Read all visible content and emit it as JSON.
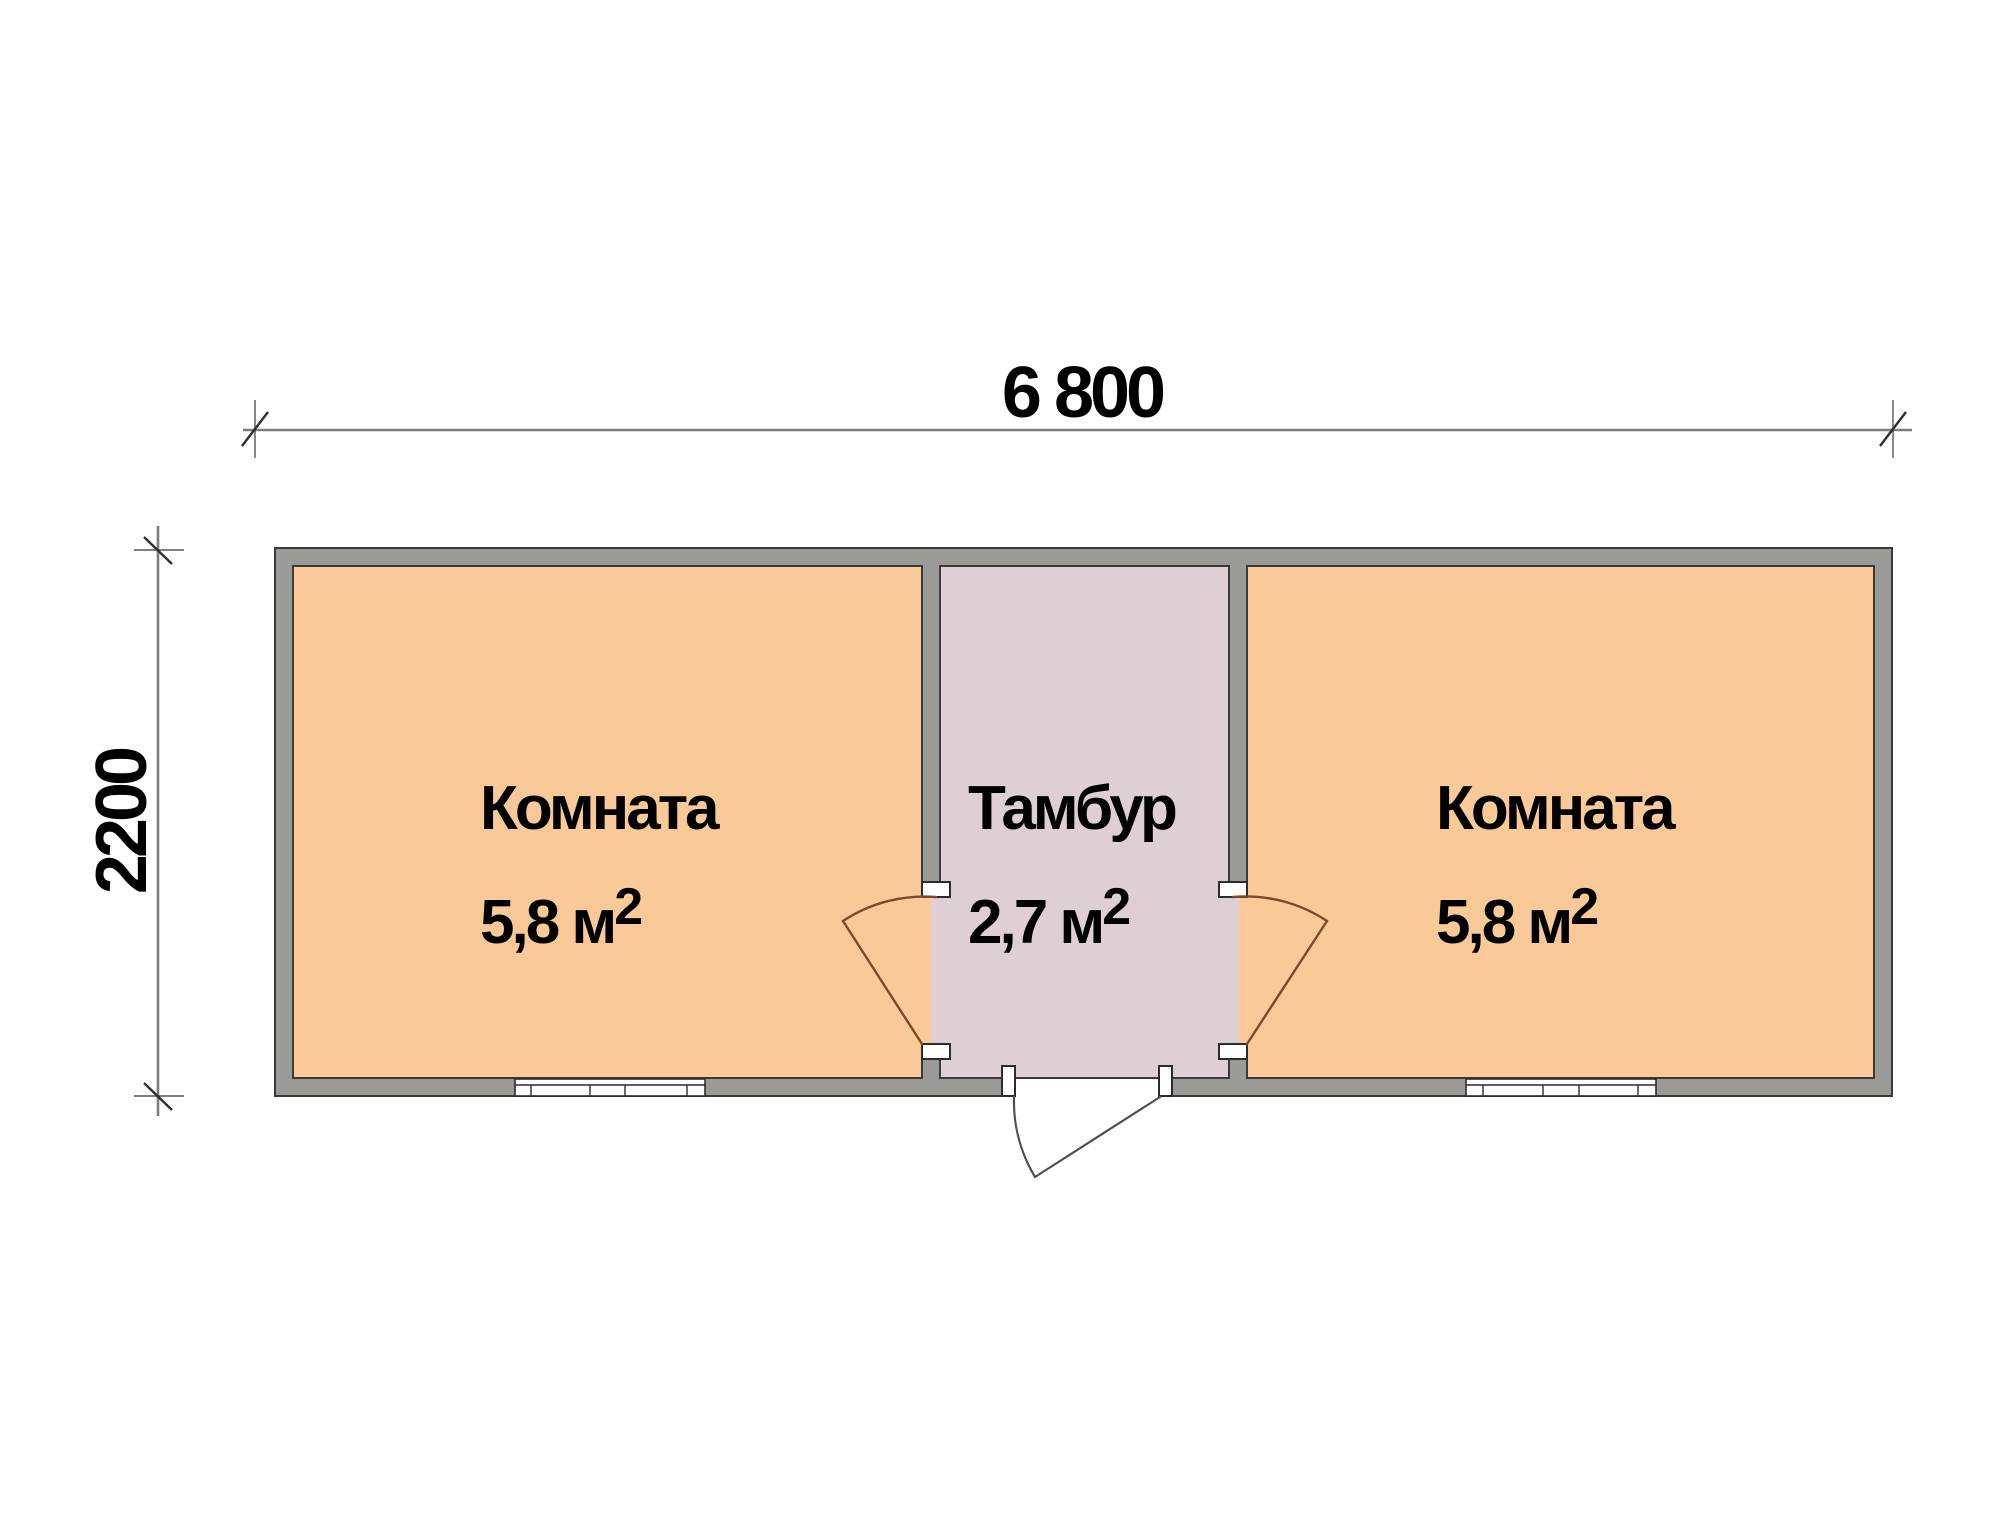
{
  "dimensions": {
    "width_label": "6 800",
    "height_label": "2200"
  },
  "rooms": [
    {
      "name": "Комната",
      "area": "5,8 м",
      "area_sup": "2"
    },
    {
      "name": "Тамбур",
      "area": "2,7 м",
      "area_sup": "2"
    },
    {
      "name": "Комната",
      "area": "5,8 м",
      "area_sup": "2"
    }
  ],
  "colors": {
    "room_fill": "#f9c997",
    "vestibule_fill": "#ddcfd4",
    "wall_fill": "#9a9b97",
    "wall_stroke": "#3a3a3a",
    "interior_door": "#7b4a2b",
    "exterior_door": "#4f4f4f",
    "dimension_line": "#7d7d7d",
    "text": "#000000",
    "background": "#ffffff"
  }
}
